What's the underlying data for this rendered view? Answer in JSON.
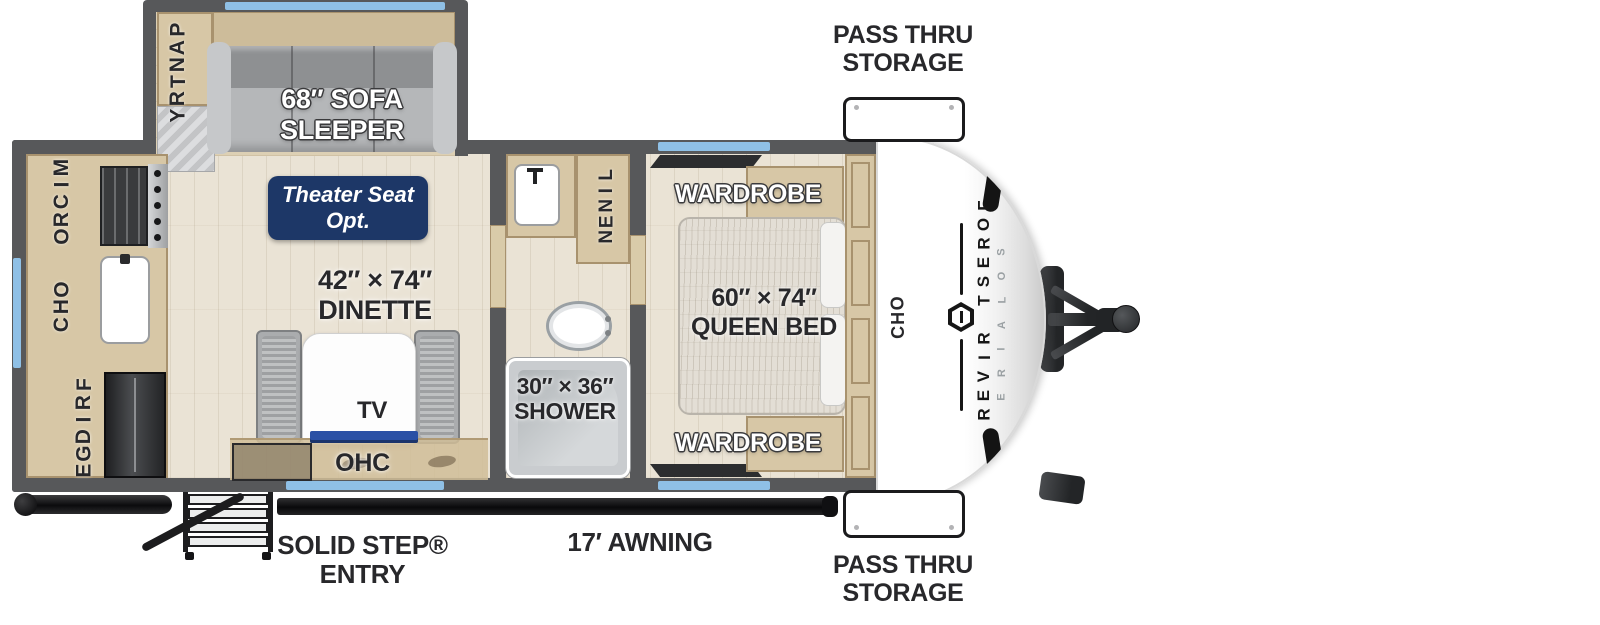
{
  "title": "Travel trailer floor plan",
  "exterior": {
    "pass_thru_top": {
      "line1": "PASS THRU",
      "line2": "STORAGE"
    },
    "pass_thru_bottom": {
      "line1": "PASS THRU",
      "line2": "STORAGE"
    },
    "entry": {
      "line1": "SOLID STEP®",
      "line2": "ENTRY"
    },
    "awning": "17′ AWNING",
    "brand": {
      "name": "FOREST RIVER",
      "model": "SOLAIRE"
    }
  },
  "rooms": {
    "kitchen": {
      "pantry": "PANTRY",
      "micro": "MICRO",
      "ohc": "OHC",
      "fridge": "FRIDGE"
    },
    "living": {
      "sofa": {
        "line1": "68″ SOFA",
        "line2": "SLEEPER"
      },
      "theater": {
        "line1": "Theater Seat",
        "line2": "Opt."
      },
      "dinette": {
        "line1": "42″ × 74″",
        "line2": "DINETTE"
      },
      "tv": "TV",
      "ohc": "OHC"
    },
    "bath": {
      "linen": "LINEN",
      "shower": {
        "line1": "30″ × 36″",
        "line2": "SHOWER"
      }
    },
    "bedroom": {
      "wardrobe_top": "WARDROBE",
      "wardrobe_bottom": "WARDROBE",
      "bed": {
        "line1": "60″ × 74″",
        "line2": "QUEEN BED"
      },
      "ohc": "OHC"
    }
  },
  "colors": {
    "wall": "#57585a",
    "floor": "#eae3d5",
    "slide_floor": "#ddd0b4",
    "counter": "#d7c7a6",
    "counter_edge": "#a8926e",
    "window": "#8fc0e6",
    "navy": "#1d3767",
    "tv_blue": "#2a50a5",
    "label_dark": "#28282b"
  }
}
